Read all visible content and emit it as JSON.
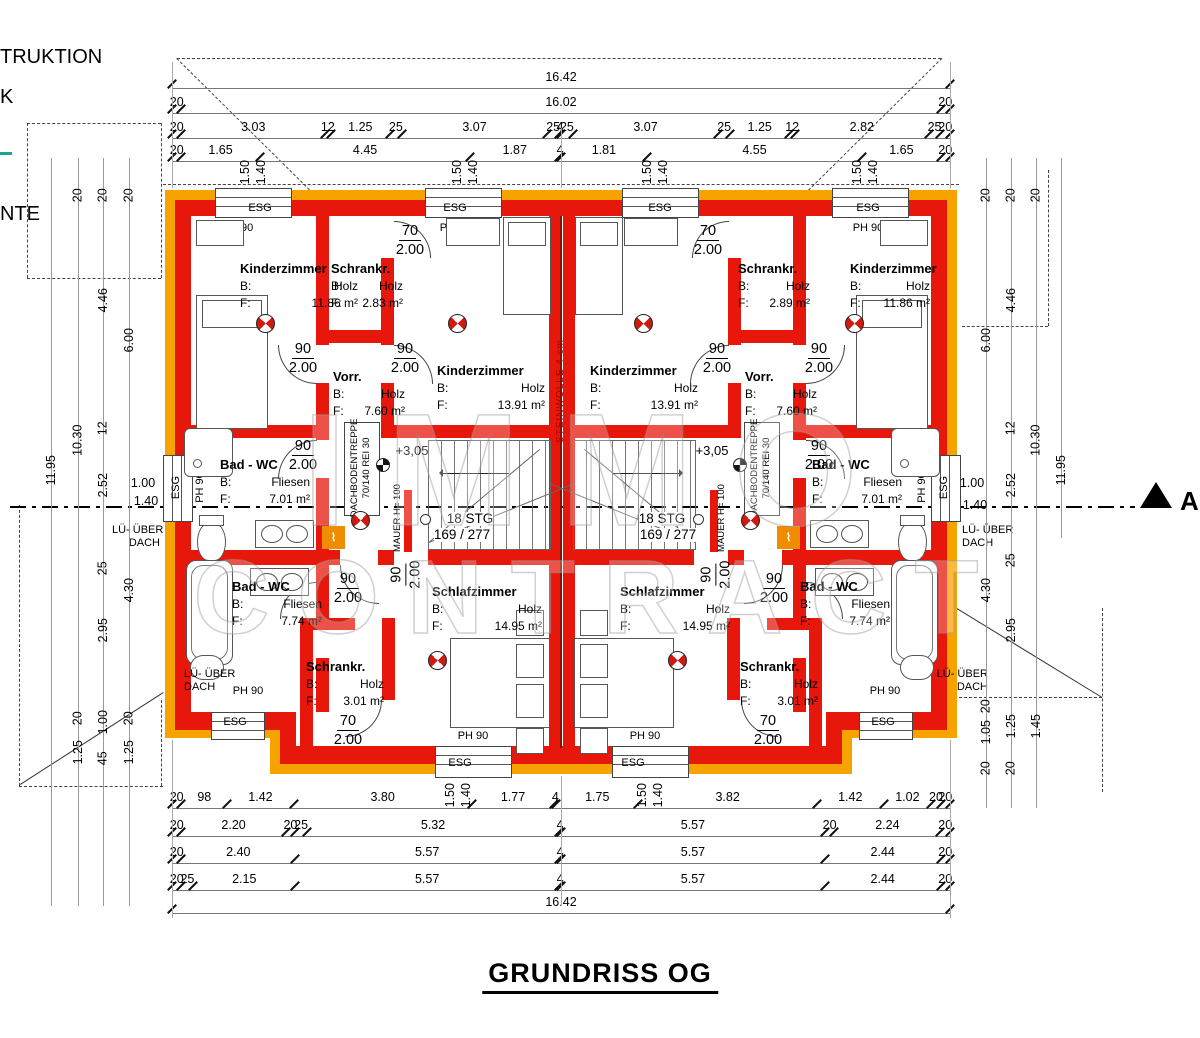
{
  "title": "GRUNDRISS OG",
  "watermark": {
    "line1": "IMMO",
    "line2": "CONTRACT"
  },
  "edge_labels": {
    "truktion": "TRUKTION",
    "k": "K",
    "nte": "NTE"
  },
  "section": {
    "label": "A"
  },
  "colors": {
    "wall_red": "#e8170b",
    "wall_orange": "#f6a300",
    "insulation_line": "#8a0e00"
  },
  "labels": {
    "b": "B:",
    "f": "F:"
  },
  "annot": {
    "level": "+3,05",
    "attic1": "DACHBODENTREPPE",
    "attic2": "70/140  REI 30",
    "mauer": "MAUER H= 100",
    "wool": "STEINWOLLE 4 cm",
    "lue1": "LÜ- ÜBER",
    "lue2": "DACH",
    "esg": "ESG",
    "ph90": "PH 90",
    "stg1": "18 STG",
    "stg2": "169 / 277"
  },
  "door_labels": {
    "d90": {
      "w": "90",
      "h": "2.00"
    },
    "d70": {
      "w": "70",
      "h": "2.00"
    }
  },
  "rooms": {
    "lk1": {
      "name": "Kinderzimmer",
      "bv": "Holz",
      "fv": "11.86 m²"
    },
    "ls1": {
      "name": "Schrankr.",
      "bv": "Holz",
      "fv": "2.83 m²"
    },
    "lk2": {
      "name": "Kinderzimmer",
      "bv": "Holz",
      "fv": "13.91 m²"
    },
    "lv": {
      "name": "Vorr.",
      "bv": "Holz",
      "fv": "7.60 m²"
    },
    "lb1": {
      "name": "Bad - WC",
      "bv": "Fliesen",
      "fv": "7.01 m²"
    },
    "lb2": {
      "name": "Bad - WC",
      "bv": "Fliesen",
      "fv": "7.74 m²"
    },
    "ls2": {
      "name": "Schrankr.",
      "bv": "Holz",
      "fv": "3.01 m²"
    },
    "lsz": {
      "name": "Schlafzimmer",
      "bv": "Holz",
      "fv": "14.95 m²"
    },
    "rk2": {
      "name": "Kinderzimmer",
      "bv": "Holz",
      "fv": "13.91 m²"
    },
    "rs1": {
      "name": "Schrankr.",
      "bv": "Holz",
      "fv": "2.89 m²"
    },
    "rk1": {
      "name": "Kinderzimmer",
      "bv": "Holz",
      "fv": "11.86 m²"
    },
    "rv": {
      "name": "Vorr.",
      "bv": "Holz",
      "fv": "7.60 m²"
    },
    "rb1": {
      "name": "Bad - WC",
      "bv": "Fliesen",
      "fv": "7.01 m²"
    },
    "rb2": {
      "name": "Bad - WC",
      "bv": "Fliesen",
      "fv": "7.74 m²"
    },
    "rs2": {
      "name": "Schrankr.",
      "bv": "Holz",
      "fv": "3.01 m²"
    },
    "rsz": {
      "name": "Schlafzimmer",
      "bv": "Holz",
      "fv": "14.95 m²"
    }
  },
  "dims": {
    "top": [
      [
        "16.42"
      ],
      [
        "20",
        "16.02",
        "20"
      ],
      [
        "20",
        "3.03",
        "12",
        "1.25",
        "25",
        "3.07",
        "25",
        "4",
        "25",
        "3.07",
        "25",
        "1.25",
        "12",
        "2.82",
        "25",
        "20"
      ],
      [
        "20",
        "1.65",
        "4.45",
        "1.87",
        "4",
        "1.81",
        "4.55",
        "1.65",
        "20"
      ]
    ],
    "bottom": [
      [
        "20",
        "98",
        "1.42",
        "3.80",
        "1.77",
        "4",
        "1.75",
        "3.82",
        "1.42",
        "1.02",
        "20",
        "20"
      ],
      [
        "20",
        "2.20",
        "20",
        "25",
        "5.32",
        "4",
        "5.57",
        "20",
        "2.24",
        "20"
      ],
      [
        "20",
        "2.40",
        "5.57",
        "4",
        "5.57",
        "2.44",
        "20"
      ],
      [
        "20",
        "25",
        "2.15",
        "5.57",
        "4",
        "5.57",
        "2.44",
        "20"
      ],
      [
        "16.42"
      ]
    ],
    "wp": [
      "1.50",
      "1.40"
    ],
    "vl": [
      "11.95",
      "10.30",
      "4.46",
      "12",
      "2.52",
      "25",
      "2.95",
      "6.00",
      "4.30",
      "20",
      "20",
      "20",
      "1.00",
      "1.40",
      "20",
      "1.00",
      "20",
      "1.25",
      "45",
      "1.25"
    ],
    "vr": [
      "4.46",
      "6.00",
      "12",
      "10.30",
      "11.95",
      "2.52",
      "1.00",
      "1.40",
      "25",
      "4.30",
      "2.95",
      "20",
      "20",
      "20",
      "20",
      "1.05",
      "1.25",
      "1.45",
      "20",
      "20"
    ]
  }
}
